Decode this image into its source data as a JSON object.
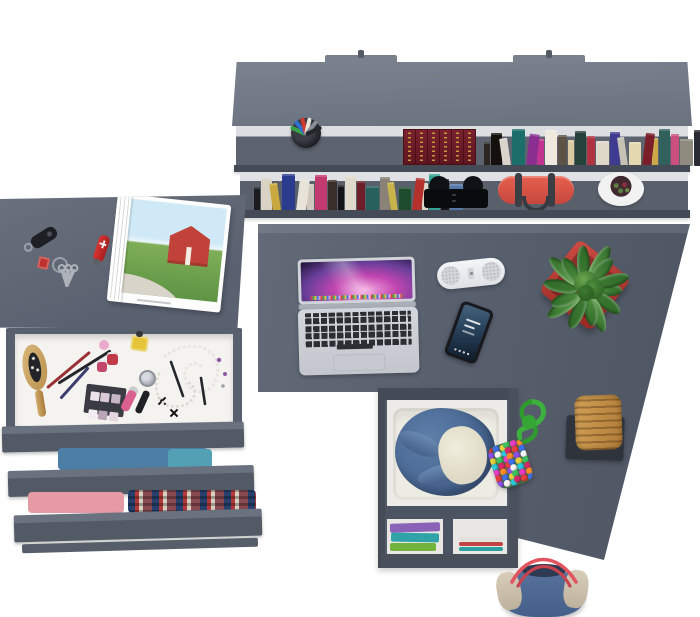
{
  "scene": {
    "description": "Top-down 3D render of a gray home-office corner: wall bookshelf, dresser with open drawers, and an L-shaped desk with accessories",
    "colors": {
      "bg": "#ffffff",
      "desk-gray": "#5a6170",
      "panel-gray": "#6e7480",
      "dark-gray": "#474d58",
      "drawer-white": "#f3f2ef"
    }
  },
  "bookshelf": {
    "mount_tab_count": 2,
    "upper_shelf": {
      "pencil_cup": {
        "cup_color": "#23252b",
        "pen_colors": [
          "#3aa04a",
          "#2f6fd0",
          "#d0392f",
          "#e8e4da",
          "#8a8d93",
          "#23252a"
        ]
      },
      "leather_book_set": {
        "volumes": 6,
        "cover_color": "#6d1a24",
        "ornament_color": "#c79a3b"
      },
      "books": {
        "spine_colors": [
          "#2b2622",
          "#14100e",
          "#d9d5cc",
          "#1b6e6a",
          "#8a2f8f",
          "#c2348f",
          "#efe9de",
          "#5c5346",
          "#d9caa1",
          "#25423a",
          "#b03341",
          "#ded8c9",
          "#3f3b90",
          "#c5c1b5",
          "#e4d8b1",
          "#7a1f2a",
          "#cba94b",
          "#32605c",
          "#c94f7d",
          "#908b7f",
          "#2b2b34",
          "#bf4a28"
        ]
      }
    },
    "lower_shelf": {
      "books": {
        "spine_colors": [
          "#1c1b20",
          "#d9d3c6",
          "#c9a93f",
          "#2b3c8f",
          "#e8e3d8",
          "#cfc9bd",
          "#c23a6e",
          "#3a2e28",
          "#151518",
          "#e0dacd",
          "#6d1f2a",
          "#27615e",
          "#8a8276",
          "#c7b34a",
          "#1e4d2e",
          "#b5312c",
          "#dcd6c8",
          "#33a393",
          "#17171a",
          "#5577aa"
        ]
      },
      "camera": {
        "body_color": "#0c0d10"
      },
      "duffel_bag": {
        "body_color": "#df5348",
        "strap_color": "#3a3f46"
      },
      "cactus_pot": {
        "pot_color": "#ffffff",
        "soil_color": "#402a30",
        "plant_colors": [
          "#5e7d42",
          "#8a3040"
        ]
      }
    }
  },
  "dresser": {
    "top_items": {
      "car_key_fob": {
        "color": "#1d1f24",
        "ring_color": "#9aa0a8"
      },
      "pocket_knife": {
        "color": "#cc2a2a",
        "cross_color": "#eeeeee"
      },
      "key_ring": {
        "metal_color": "#9aa0a8",
        "tag_color": "#c0322e",
        "key_count": 3
      },
      "magazine": {
        "page_color": "#ffffff",
        "photo": {
          "sky": "#cfe9f6",
          "grass": "#79ad55",
          "barn": "#c04238",
          "road": "#d9d4c9"
        }
      }
    },
    "makeup_drawer": {
      "interior_color": "#f4f3f0",
      "items": [
        "wooden-hairbrush",
        "makeup-brushes",
        "pencil",
        "perfume-bottles",
        "nail-polish",
        "yellow-bottle",
        "silver-jar",
        "eyeshadow-palette",
        "lip-gloss",
        "mascara",
        "pearl-necklaces",
        "earrings",
        "black-bow-clips"
      ],
      "palette_pans": [
        "#ece3ea",
        "#dcc9d8",
        "#c6b5c5",
        "#f3ecf0",
        "#b8a5b7",
        "#e5d5df"
      ],
      "brush_colors": [
        "#9a3035",
        "#24262b",
        "#3c3f6e"
      ]
    },
    "clothes_drawers": [
      {
        "contents": "folded blue shirt",
        "colors": [
          "#4d7fa6",
          "#53a0b4"
        ]
      },
      {
        "contents": "folded pink clothes and plaid shirt",
        "colors": [
          "#e59aa4",
          "#8a4a52",
          "#27406e",
          "#d8cfc0"
        ]
      }
    ]
  },
  "desk": {
    "laptop": {
      "body_color": "#cdd0d5",
      "key_color": "#2c2e33",
      "wallpaper_colors": [
        "#f2a8e0",
        "#c245b0",
        "#6a3f9a",
        "#1d1233"
      ]
    },
    "speaker": {
      "body_color": "#eef0f2",
      "grille_color": "#d4d6da"
    },
    "smartphone": {
      "body_color": "#17191d",
      "screen_colors": [
        "#46637e",
        "#101c2a"
      ]
    },
    "succulent_planter": {
      "pot_color": "#b8352f",
      "leaf_colors": [
        "#4e8f3e",
        "#3d7a30",
        "#69a84f"
      ],
      "leaf_count": 14
    },
    "pompom_charm": {
      "cord_color": "#3cb23c",
      "pompom_colors": [
        "#e43f3f",
        "#3f6fe4",
        "#e4d03f",
        "#3fbf5f",
        "#e43fc0",
        "#ff8c29",
        "#8a4fe4",
        "#f5f5f5",
        "#29c8d8",
        "#d42a6a"
      ]
    },
    "wicker_stool": {
      "seat_color": "#c08a45",
      "base_color": "#2f343c"
    },
    "pedestal": {
      "open_shelf_top": {
        "contents": "denim jacket on white blanket",
        "denim_color": "#4e6f99",
        "lining_color": "#e6e3d2"
      },
      "open_shelf_bottom": {
        "contents": "folded clothes and magazines",
        "clothes_colors": [
          "#8a63b8",
          "#2fa3a8",
          "#71b33c"
        ],
        "magazine_colors": [
          "#e3e1dc",
          "#c04444",
          "#2aa0a0",
          "#d8d6d0"
        ]
      }
    }
  },
  "floor_bag": {
    "body_color": "#4d6b94",
    "trim_color": "#cfc4b0",
    "handle_color": "#e05560"
  }
}
